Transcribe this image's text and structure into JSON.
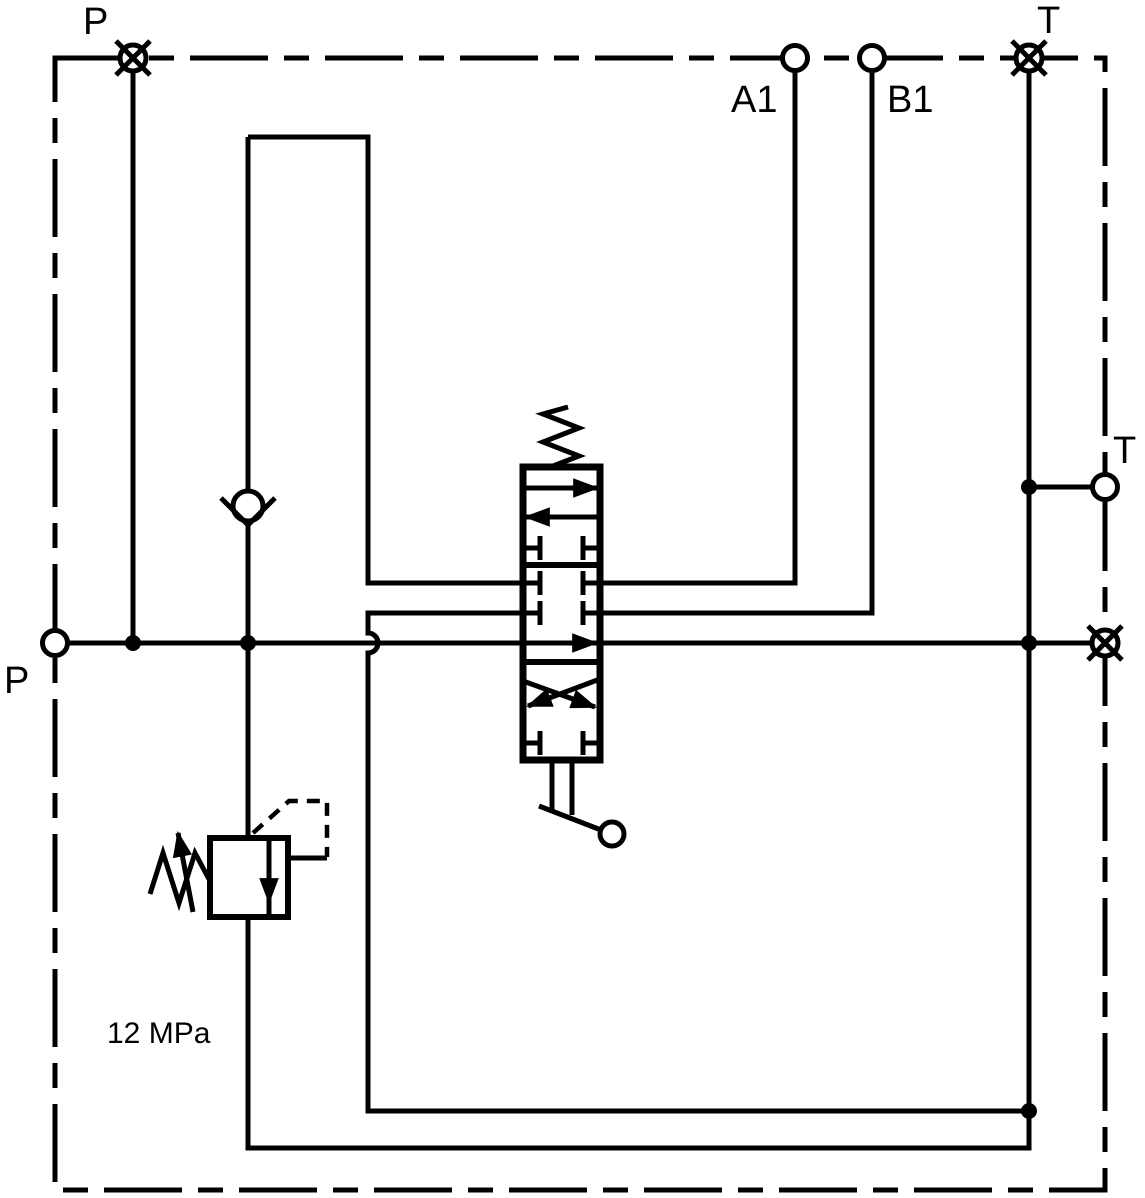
{
  "diagram": {
    "kind": "hydraulic-valve-block-schematic",
    "colors": {
      "line": "#000000",
      "background": "#ffffff"
    },
    "labels": {
      "port_p_top": "P",
      "port_a1": "A1",
      "port_b1": "B1",
      "port_t_top": "T",
      "port_t_right": "T",
      "port_p_left": "P",
      "relief_setting": "12 MPa"
    },
    "components": {
      "enclosure": "valve-block-boundary-chain-line",
      "directional_valve": "3-position-lever-spool-valve-spring-return",
      "check_valve": "check-valve",
      "relief_valve": "adjustable-pressure-relief-valve",
      "plugged_ports": [
        "P-top",
        "T-top",
        "right-side"
      ],
      "open_ports": [
        "A1",
        "B1",
        "T-right",
        "P-left"
      ]
    }
  }
}
